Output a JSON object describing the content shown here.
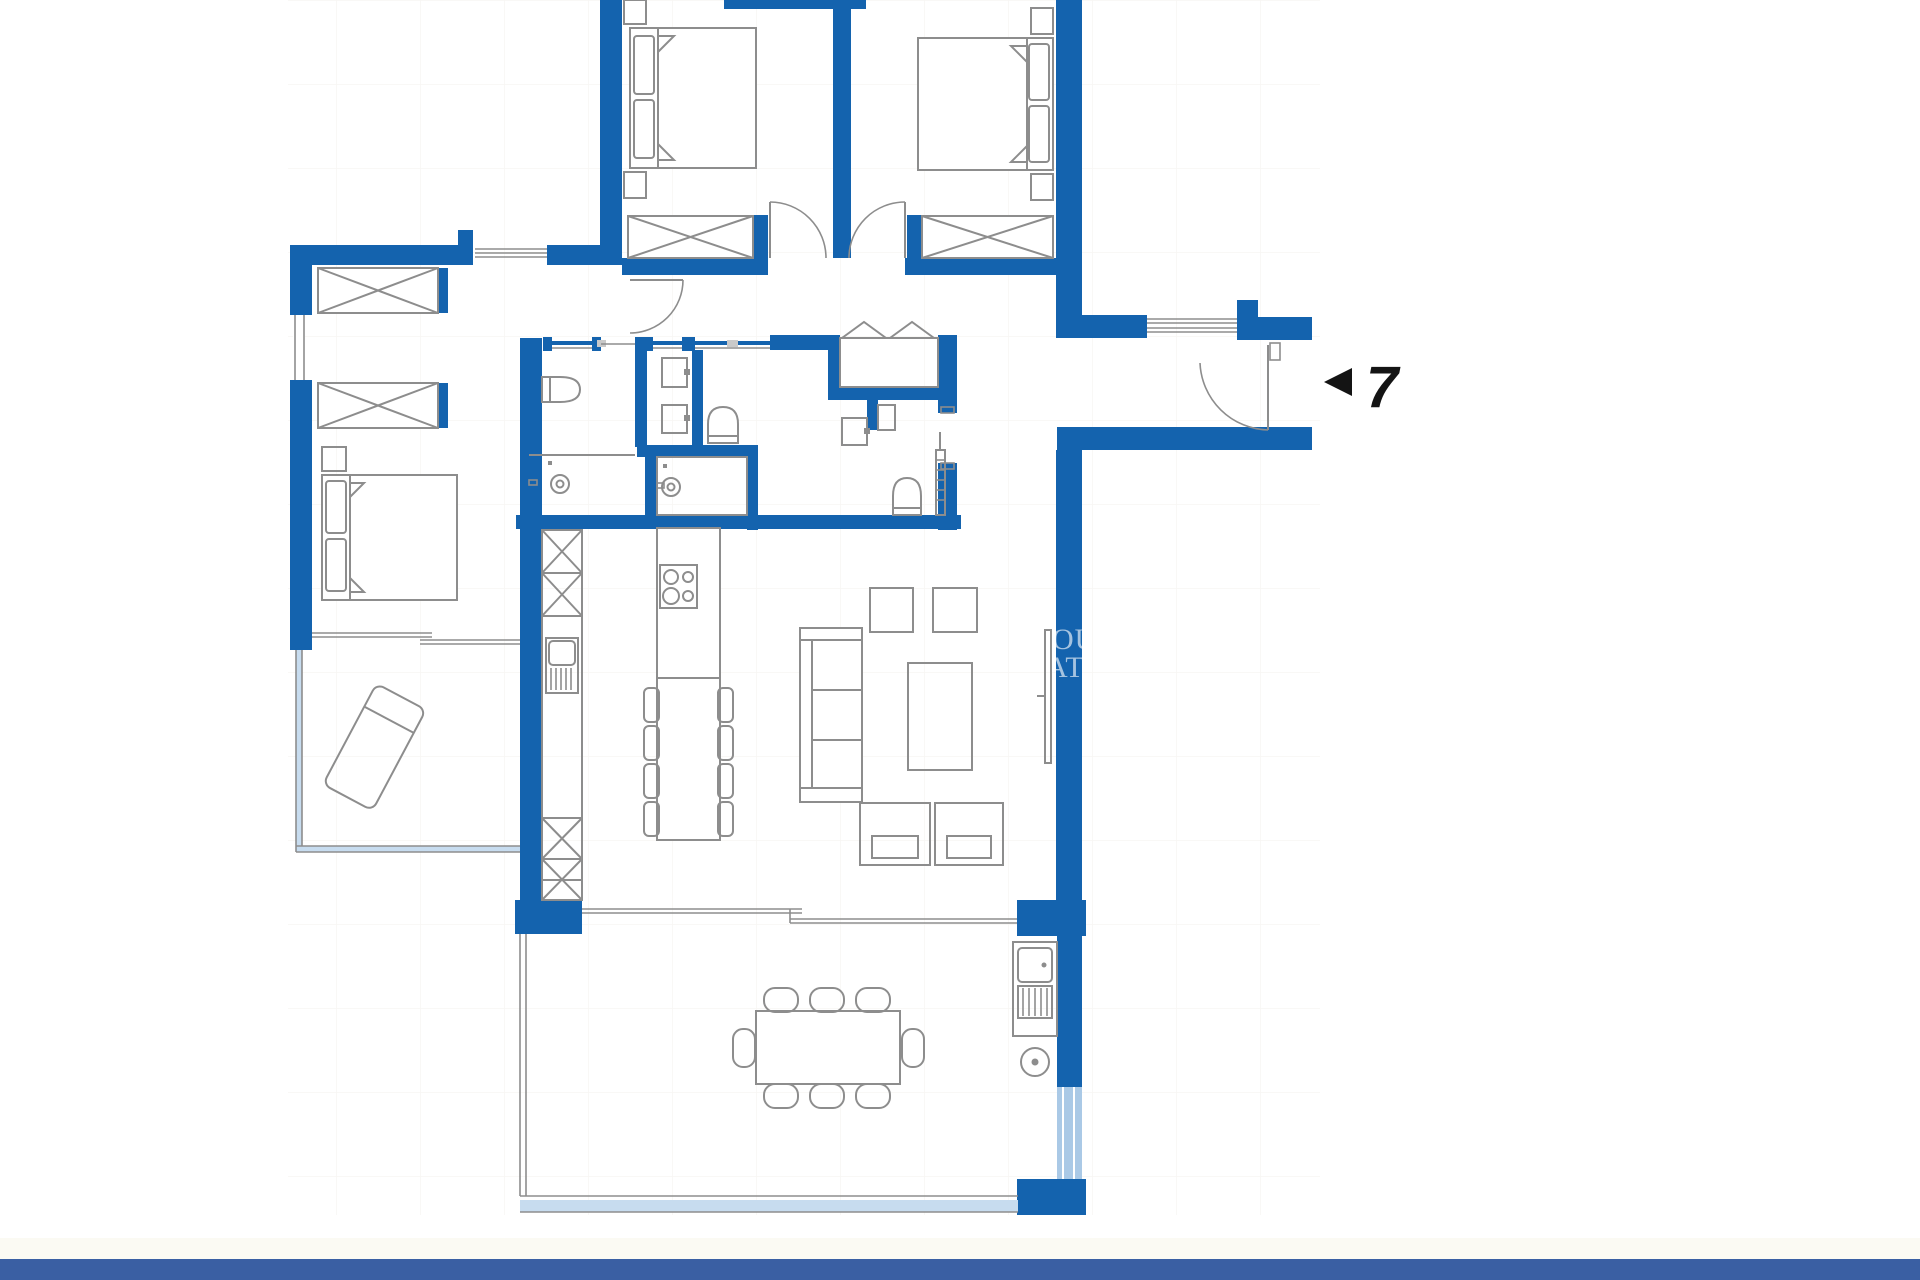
{
  "page": {
    "background_color": "#ffffff"
  },
  "colors": {
    "page_bg": "#ffffff",
    "wall": "#1463ae",
    "footer_bar": "#3a5fa3",
    "footer_strip": "#fbfaf3",
    "glass": "#c7dcef",
    "glass_deep": "#aac9e6",
    "line": "#8d8d8d",
    "line_light": "#c9c9c9",
    "grid": "#f1efe9",
    "text_black": "#141414",
    "watermark_white": "rgba(255,255,255,0.62)"
  },
  "entrance_marker": {
    "arrow_icon": "left-triangle",
    "unit_label": "7"
  },
  "watermark": {
    "fragment_line1": "OU",
    "fragment_line2": "AT"
  }
}
